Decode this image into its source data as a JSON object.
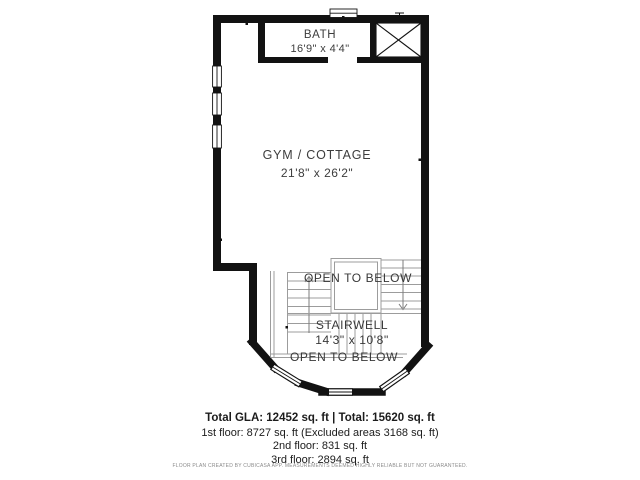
{
  "plan": {
    "bath_label": "BATH",
    "bath_dims": "16'9\" x 4'4\"",
    "gym_label": "GYM / COTTAGE",
    "gym_dims": "21'8\" x 26'2\"",
    "open_below_top": "OPEN TO BELOW",
    "stairwell_label": "STAIRWELL",
    "stairwell_dims": "14'3\" x 10'8\"",
    "open_below_bottom": "OPEN TO BELOW",
    "colors": {
      "wall": "#121212",
      "thin_line": "#9c9c9c",
      "label": "#3d3d3d"
    }
  },
  "summary": {
    "total_line": "Total GLA: 12452 sq. ft | Total: 15620 sq. ft",
    "floor1": "1st floor: 8727 sq. ft (Excluded areas 3168 sq. ft)",
    "floor2": "2nd floor: 831 sq. ft",
    "floor3": "3rd floor: 2894 sq. ft"
  },
  "disclaimer": "FLOOR PLAN CREATED BY CUBICASA APP. MEASUREMENTS DEEMED HIGHLY RELIABLE BUT NOT GUARANTEED."
}
